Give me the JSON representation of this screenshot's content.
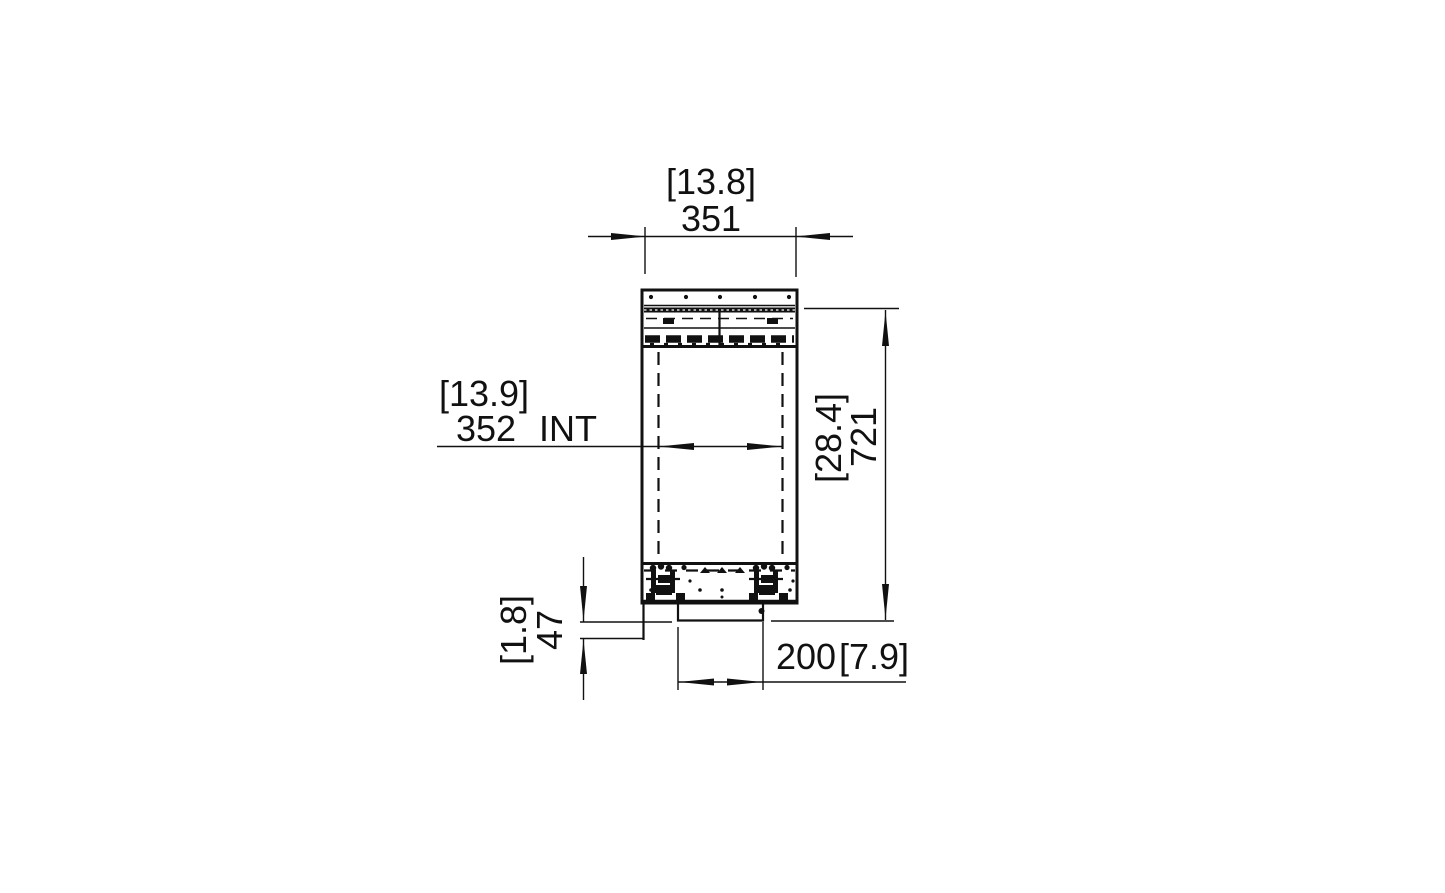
{
  "colors": {
    "line": "#111111",
    "background": "#ffffff"
  },
  "dimensions": {
    "top_width": {
      "imperial": "[13.8]",
      "metric": "351"
    },
    "internal_width": {
      "imperial": "[13.9]",
      "metric": "352",
      "suffix": "INT"
    },
    "overall_height": {
      "imperial": "[28.4]",
      "metric": "721"
    },
    "bottom_offset": {
      "imperial": "[1.8]",
      "metric": "47"
    },
    "bottom_width": {
      "metric": "200",
      "imperial": "[7.9]"
    }
  }
}
